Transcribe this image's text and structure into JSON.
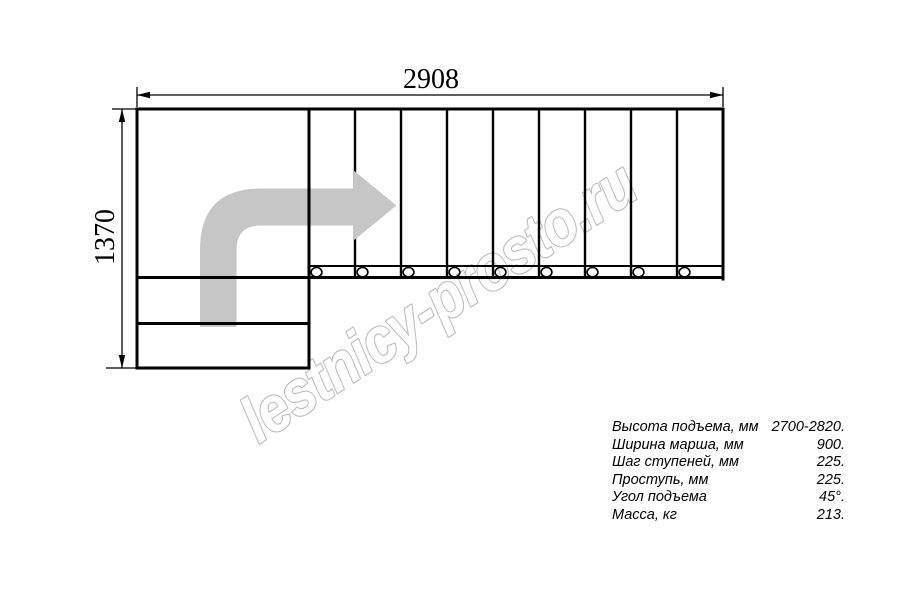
{
  "colors": {
    "line": "#000000",
    "arrow_fill": "#c6c6c6",
    "watermark_stroke": "#bcbcbc"
  },
  "dimensions": {
    "width_label": "2908",
    "height_label": "1370"
  },
  "watermark": {
    "text": "lestnicy-prosto.ru"
  },
  "plan": {
    "flight_treads": 9,
    "lower_wide_steps": 2,
    "tread_circle_count": 9,
    "turn_direction": "left-to-right"
  },
  "specs": {
    "rows": [
      {
        "label": "Высота подъема, мм",
        "value": "2700-2820."
      },
      {
        "label": "Ширина марша, мм",
        "value": "900."
      },
      {
        "label": "Шаг ступеней, мм",
        "value": "225."
      },
      {
        "label": "Проступь, мм",
        "value": "225."
      },
      {
        "label": "Угол подъема",
        "value": "45°."
      },
      {
        "label": "Масса, кг",
        "value": "213."
      }
    ]
  }
}
